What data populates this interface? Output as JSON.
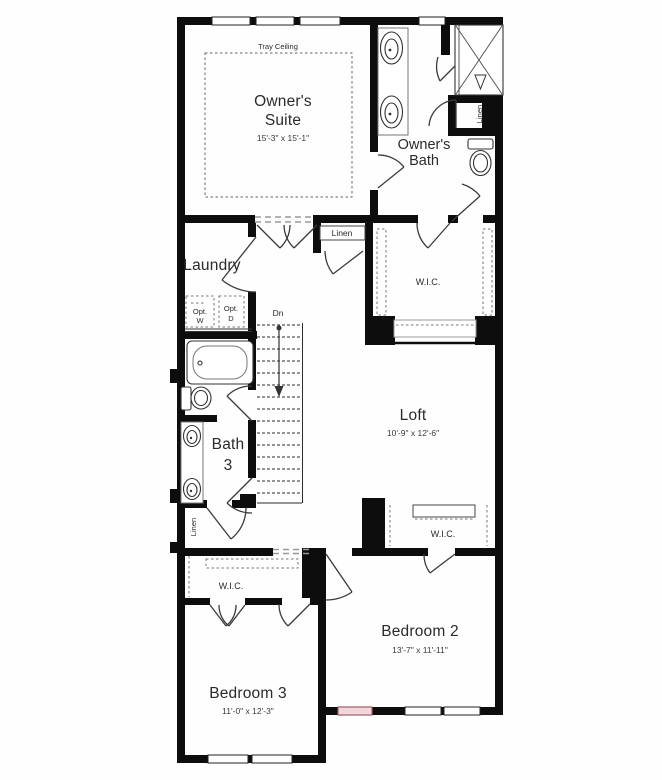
{
  "floorplan": {
    "background": "#fefefe",
    "wall_color": "#0d0d0d",
    "rooms": {
      "owners_suite": {
        "label": [
          "Owner's",
          "Suite"
        ],
        "dims": "15'-3\" x 15'-1\"",
        "ceiling": "Tray Ceiling"
      },
      "owners_bath": {
        "label": [
          "Owner's",
          "Bath"
        ]
      },
      "laundry": {
        "label": "Laundry"
      },
      "bath_3": {
        "label": [
          "Bath",
          "3"
        ]
      },
      "loft": {
        "label": "Loft",
        "dims": "10'-9\" x 12'-6\""
      },
      "bedroom_2": {
        "label": "Bedroom 2",
        "dims": "13'-7\" x 11'-11\""
      },
      "bedroom_3": {
        "label": "Bedroom 3",
        "dims": "11'-0\" x 12'-3\""
      }
    },
    "closets": {
      "linen_owners_bath": "Linen",
      "linen_hall": "Linen",
      "linen_downstairs_hall": "Linen",
      "wic_owners": "W.I.C.",
      "wic_bedroom_2": "W.I.C.",
      "wic_bedroom_3": "W.I.C."
    },
    "stairs": {
      "direction": "Dn"
    },
    "appliances": {
      "washer": [
        "Opt.",
        "W"
      ],
      "dryer": [
        "Opt.",
        "D"
      ]
    },
    "highlight_window": {
      "fill": "#f3d6dc",
      "border": "#9a6067"
    }
  }
}
